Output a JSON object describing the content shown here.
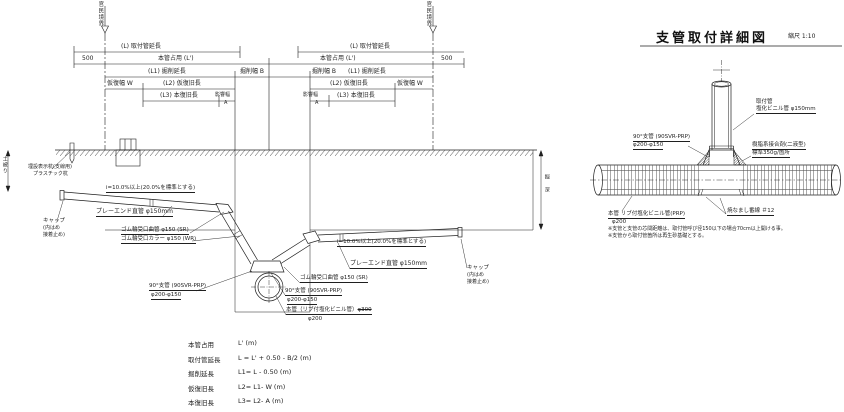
{
  "colors": {
    "ink": "#1f1f1f",
    "bg": "#ffffff"
  },
  "main": {
    "boundary_label": "官民境界",
    "boundary_mark": "▽",
    "dim_l": "(L) 取付管延長",
    "dim_500": "500",
    "dim_honkan": "本管占用 (L')",
    "dim_l1": "(L1) 掘削延長",
    "dim_b": "掘削幅 B",
    "dim_w": "仮復幅 W",
    "dim_l2": "(L2) 仮復旧長",
    "dim_l3": "(L3) 本復旧長",
    "dim_a1": "影響幅",
    "dim_a2": "A",
    "depth_v": "掘 深",
    "cover_v": "土被り",
    "stake1": "埋設表示杭(支線用)",
    "stake2": "プラスチック杭",
    "slope": "i=10.0%以上(20.0%を標準とする)",
    "cap1": "キャップ",
    "cap2": "(内はめ",
    "cap3": "接着止め)",
    "plain_pipe": "プレーエンド直管 φ150mm",
    "bend": "ゴム輪受口曲管 φ150 (SR)",
    "collar": "ゴム輪受口カラー φ150 (WR)",
    "branch1": "90°支管 (90SVR-PRP)",
    "branch2": "φ200-φ150",
    "mainpipe1": "本管（リブ付塩化ビニル管）",
    "mainpipe_old": "φ300",
    "mainpipe2": "φ200"
  },
  "detail": {
    "title": "支管取付詳細図",
    "scale": "縮尺 1:10",
    "attach1": "取付管",
    "attach2": "塩化ビニル管 φ150mm",
    "branch1": "90°支管 (90SVR-PRP)",
    "branch2": "φ200-φ150",
    "adhesive1": "樹脂系接合剤(二液型)",
    "adhesive2": "標準350g/箇所",
    "main1": "本管 リブ付塩化ビニル管(PRP)",
    "main2": "φ200",
    "wire": "焼なまし番線 ＃12",
    "note1": "※支管と支管の芯間距離は、取付管呼び径150以下の場合70cm以上開ける事。",
    "note2": "※支管から取付管箇所は再生砂基礎とする。"
  },
  "legend": {
    "rows": [
      {
        "name": "本管占用",
        "formula": "L' (m)"
      },
      {
        "name": "取付管延長",
        "formula": "L = L' + 0.50 - B/2 (m)"
      },
      {
        "name": "掘削延長",
        "formula": "L1= L - 0.50 (m)"
      },
      {
        "name": "仮復旧長",
        "formula": "L2= L1- W (m)"
      },
      {
        "name": "本復旧長",
        "formula": "L3= L2- A (m)"
      },
      {
        "name": "掘　深",
        "formula": "H (標準 1.00 m )"
      }
    ]
  }
}
